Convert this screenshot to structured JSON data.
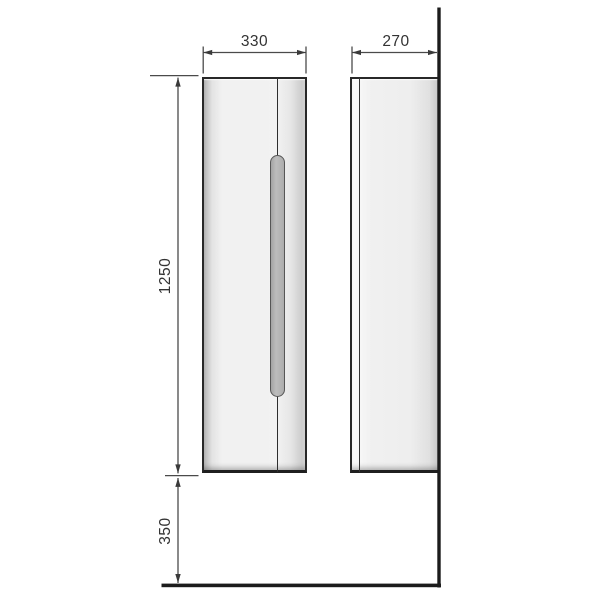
{
  "drawing": {
    "type": "furniture-technical-drawing",
    "views": {
      "front": "cabinet front view",
      "side": "cabinet side view"
    },
    "labels": {
      "width": "330",
      "depth": "270",
      "height": "1250",
      "clearance": "350"
    },
    "colors": {
      "background": "#ffffff",
      "dimension_line": "#4a4a4a",
      "text": "#333333",
      "wall_floor": "#1c1c1c",
      "cabinet_edge": "#282828",
      "cabinet_fill": "#f1f1f1",
      "handle_fill": "#b0b0b0",
      "handle_stroke": "#565656"
    }
  }
}
